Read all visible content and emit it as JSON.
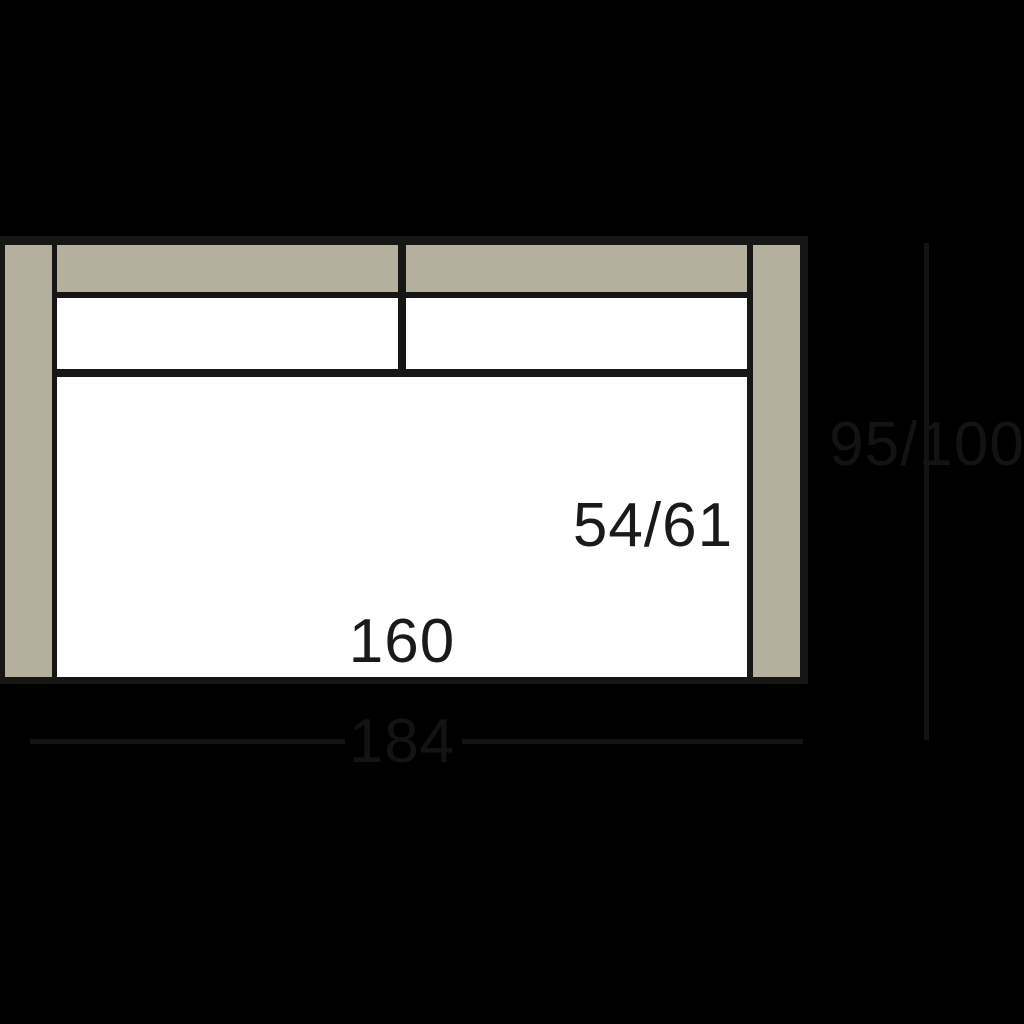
{
  "diagram": {
    "type": "sofa-top-view-dimension-diagram",
    "labels": {
      "seat_depth": "54/61",
      "seat_width": "160",
      "overall_width": "184",
      "overall_depth": "95/100"
    },
    "colors": {
      "background": "#000000",
      "frame_tan": "#b4b09d",
      "cushion_white": "#ffffff",
      "outline": "#161614",
      "dimension_annotation": "#131313",
      "label_text": "#1a1a1a"
    }
  }
}
